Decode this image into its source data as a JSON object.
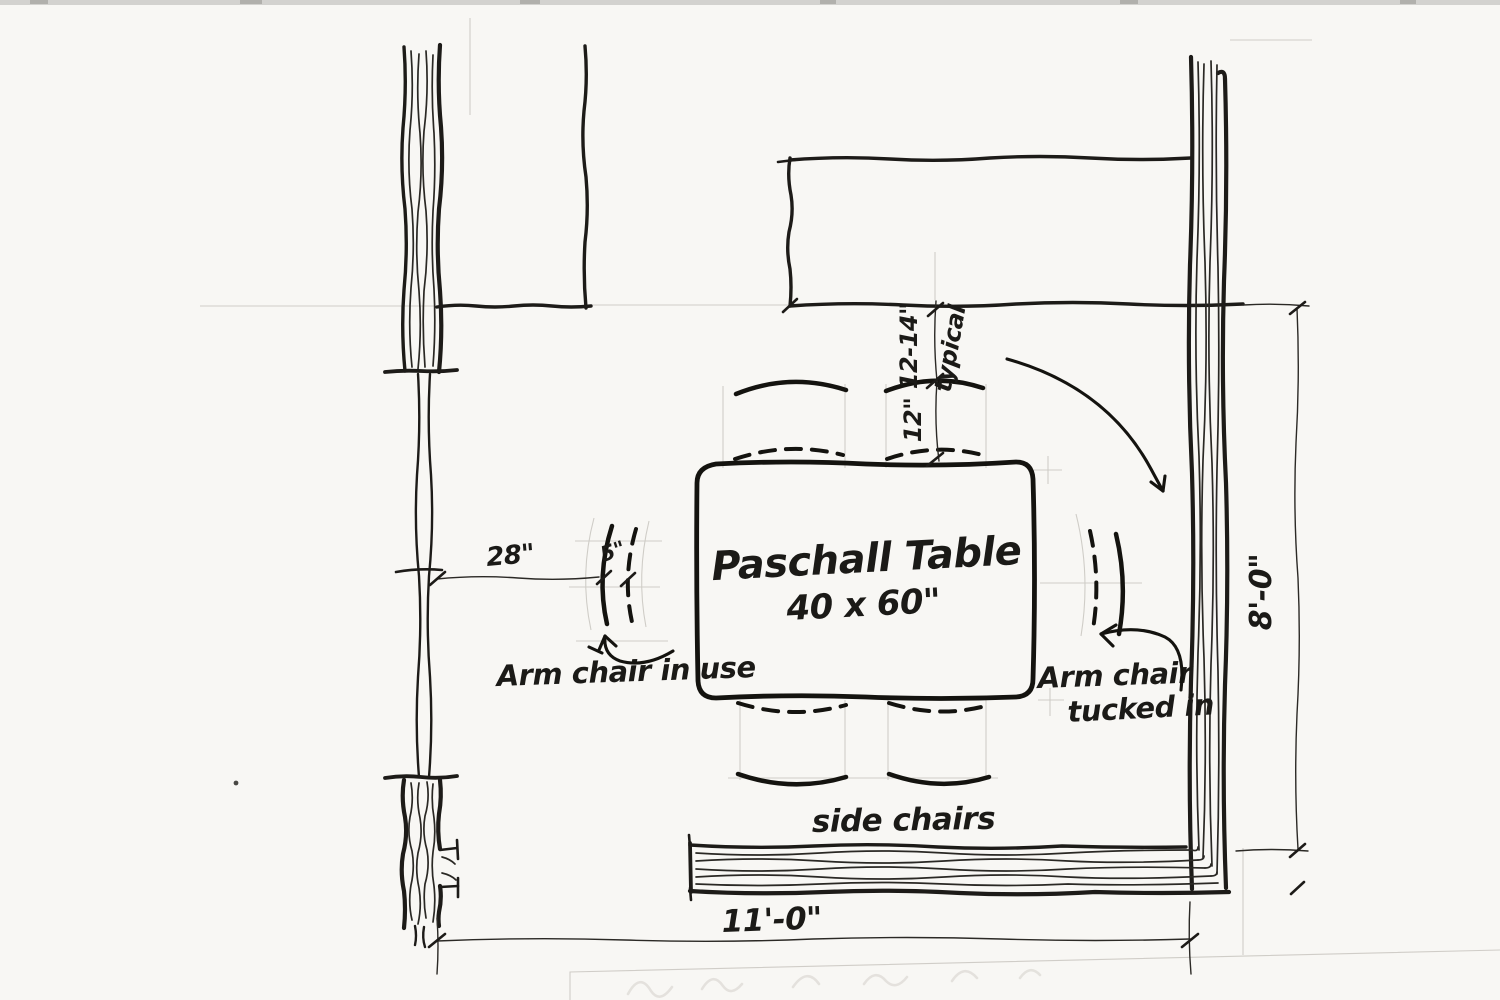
{
  "plan": {
    "table": {
      "label": "Paschall Table",
      "size": "40 x 60\""
    },
    "dimensions": {
      "wall_to_chair": "28\"",
      "chair_pullout": "5\"",
      "counter_to_chair_range": "12-14\"",
      "typical_word": "typical",
      "chair_to_table": "12\"",
      "room_depth": "8'-0\"",
      "room_width": "11'-0\""
    },
    "labels": {
      "arm_chair_in_use": "Arm chair in use",
      "arm_chair_tucked_line1": "Arm chair",
      "arm_chair_tucked_line2": "tucked in",
      "side_chairs": "side chairs"
    },
    "colors": {
      "ink": "#1d1b18",
      "paper": "#f8f7f4",
      "pencil": "#c9c6c0"
    }
  }
}
